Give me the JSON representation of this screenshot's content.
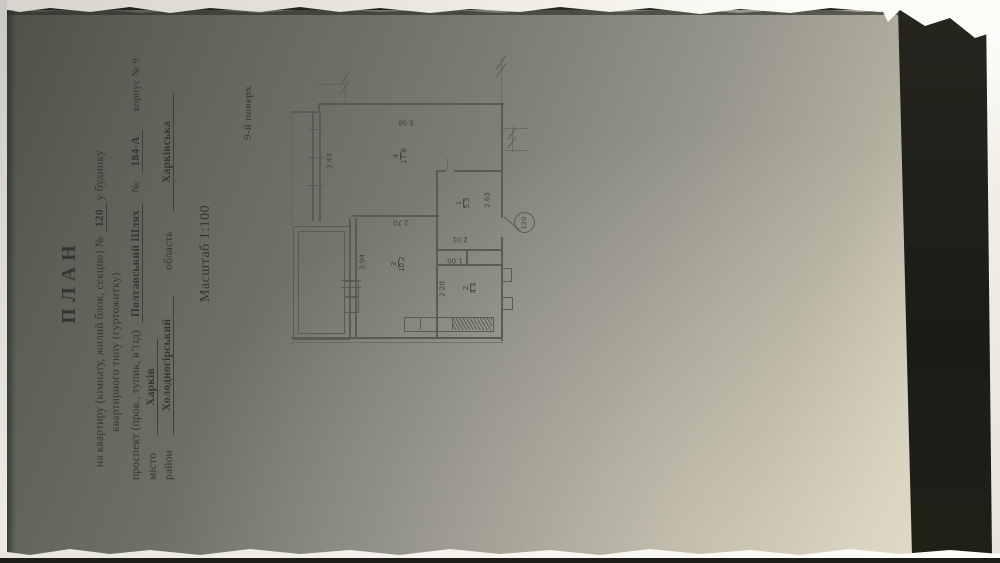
{
  "document": {
    "title": "ПЛАН",
    "line1_pre": "на квартиру (кімнату, жилий блок, секцію) №",
    "apartment_number": "120",
    "line1_post": "у будинку",
    "line2": "квартирного типу (гуртожитку)",
    "address_label": "проспект (пров., тупик, в’їзд)",
    "street_name": "Полтавський Шлях",
    "number_sign": "№",
    "building_number": "184-А",
    "korpus_label": "корпус № 9",
    "city_label": "місто",
    "city_value": "Харків",
    "district_label": "район",
    "district_value": "Холодногірський",
    "region_label": "область",
    "region_value": "Харківська",
    "scale": "Масштаб 1:100",
    "floor": "9-й поверх"
  },
  "plan": {
    "apartment_circle_number": "120",
    "rooms": [
      {
        "number": "4",
        "area": "17.8"
      },
      {
        "number": "3",
        "area": "10.2"
      },
      {
        "number": "1",
        "area": "5.3"
      },
      {
        "number": "2",
        "area": "4.4"
      }
    ],
    "dimensions": {
      "d598": "5.98",
      "d343": "3.43",
      "d270": "2.70",
      "d394": "3.94",
      "d263": "2.63",
      "d201": "2.01",
      "d100": "1.00",
      "d220": "2.20"
    }
  }
}
